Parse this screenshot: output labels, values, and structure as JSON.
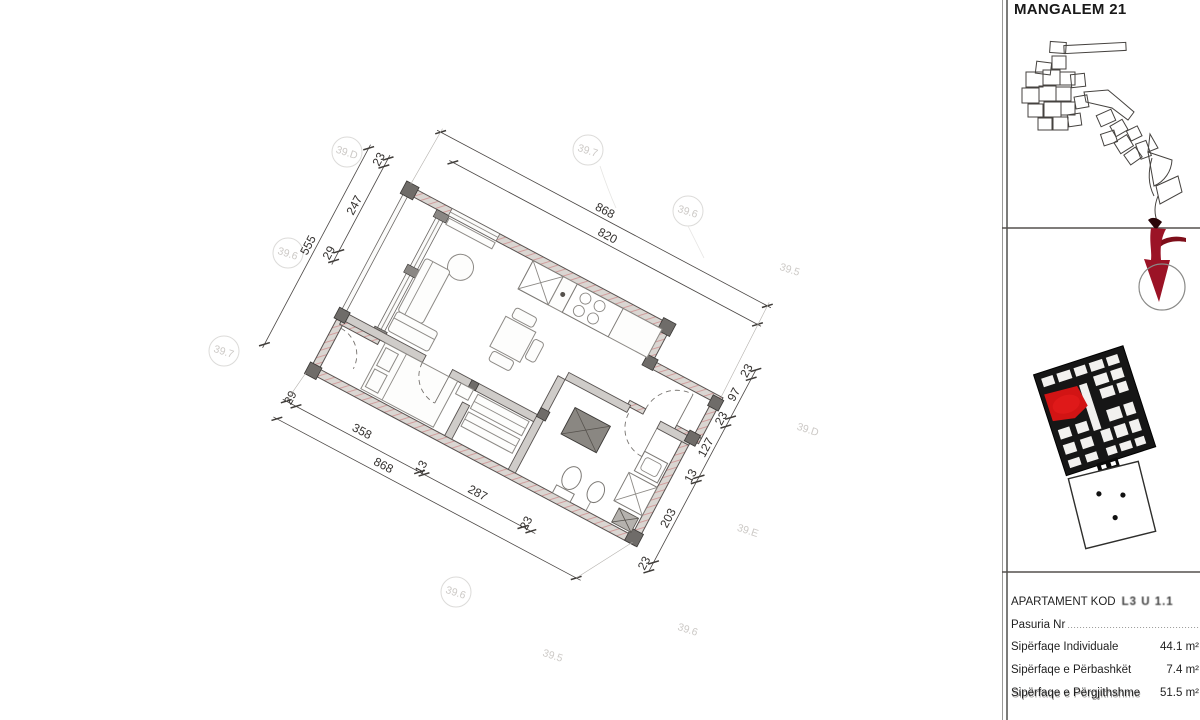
{
  "sidebar": {
    "project_title": "MANGALEM 21",
    "apartment": {
      "code_label": "APARTAMENT KOD",
      "code_value": "L3 U 1.1",
      "pasuria_label": "Pasuria Nr",
      "pasuria_leader": "..............................................",
      "rows": [
        {
          "label": "Sipërfaqe Individuale",
          "value": "44.1 m²"
        },
        {
          "label": "Sipërfaqe e Përbashkët",
          "value": "7.4 m²"
        },
        {
          "label": "Sipërfaqe e Përgjithshme",
          "value": "51.5 m²"
        }
      ]
    }
  },
  "plan": {
    "dims": {
      "top_outer": "868",
      "top_inner": "820",
      "left_outer": "555",
      "left_chain": [
        "23",
        "247",
        "29"
      ],
      "bottom_chain": [
        "29",
        "358",
        "13",
        "287",
        "23"
      ],
      "bottom_outer": "868",
      "right_chain": [
        "23",
        "97",
        "23",
        "127",
        "13",
        "203",
        "23"
      ]
    },
    "grid_bubbles": [
      {
        "label": "39.D"
      },
      {
        "label": "39.7"
      },
      {
        "label": "39.6"
      },
      {
        "label": "39.5"
      },
      {
        "label": "39.6"
      },
      {
        "label": "39.7"
      },
      {
        "label": "39.D"
      },
      {
        "label": "39.E"
      },
      {
        "label": "39.6"
      },
      {
        "label": "39.5"
      },
      {
        "label": "39.6"
      }
    ],
    "colors": {
      "wall_hatch": "#d09494",
      "unit_highlight": "#d21414",
      "locator_arrow": "#8f1020"
    }
  }
}
